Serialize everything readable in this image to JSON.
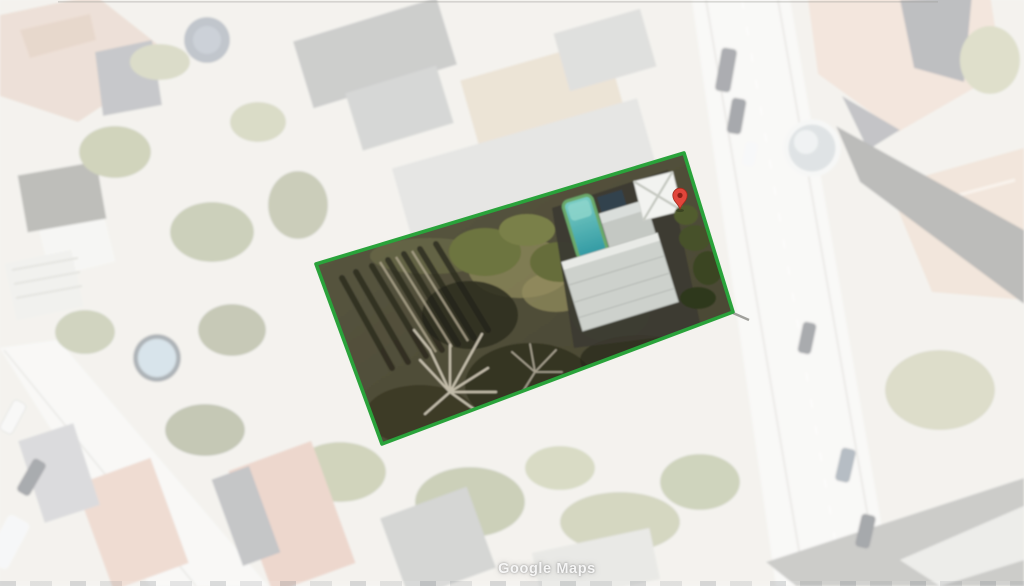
{
  "watermark": {
    "label": "Google Maps"
  },
  "parcel": {
    "points": "316,264 684,153 733,312 382,444",
    "outline_color": "#2aa33b"
  },
  "marker": {
    "transform": "translate(680,209)",
    "fill": "#e2463b",
    "border": "#a32b1d"
  },
  "colors": {
    "canvas_base": "#e9e6e0",
    "fade_overlay": "#ffffff",
    "fade_overlay_opacity": "0.55",
    "pool_water": "#2f98a2",
    "pool_rim": "#6aa96b",
    "parcel_ground": "#55533e"
  }
}
